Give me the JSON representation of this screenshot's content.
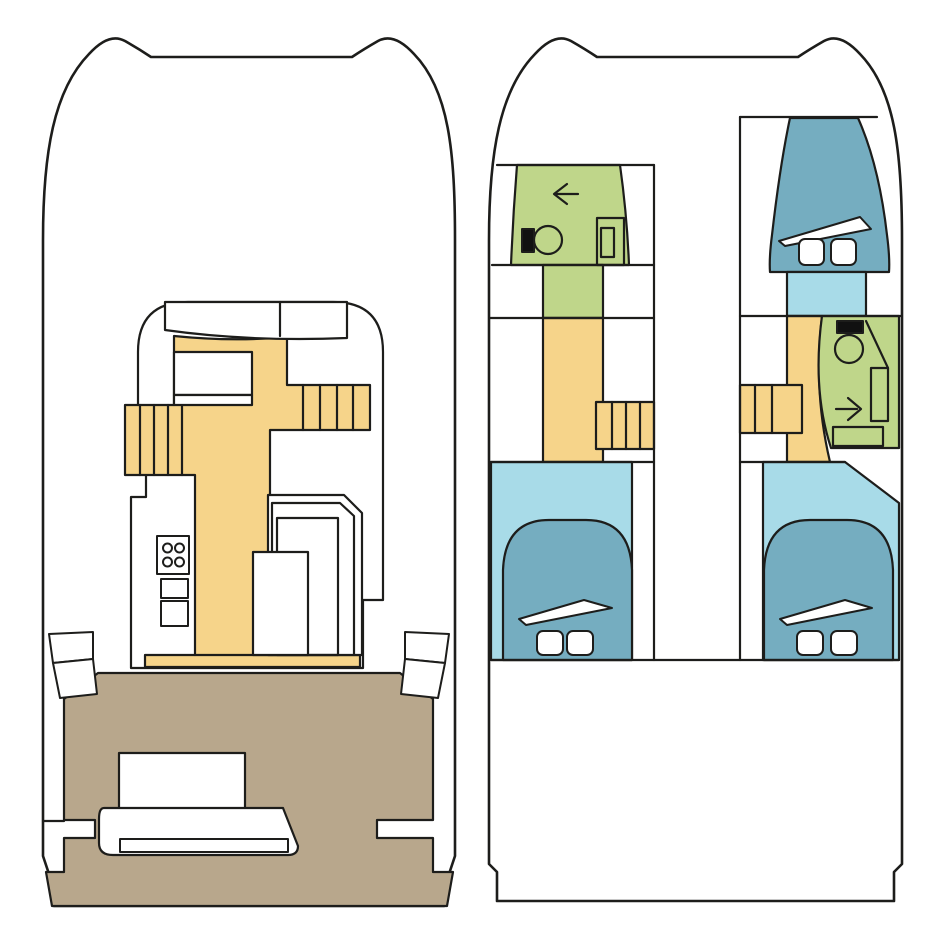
{
  "page": {
    "title": "Catamaran deck plans",
    "description": "Top-view floor plan of a sailing catamaran shown as two drawings: main deck (saloon, galley, cockpit) on the left and lower deck (hull cabins, heads, stairs) on the right."
  },
  "colors": {
    "background": "#ffffff",
    "outline": "#1d1d1b",
    "white": "#ffffff",
    "walkway_yellow": "#f6d48a",
    "cockpit_brown": "#b8a78c",
    "bathroom_green": "#bfd68a",
    "cabin_blue": "#a8dbe8",
    "bed_blue": "#75adc0",
    "fixture_black": "#111111"
  },
  "plans": [
    {
      "id": "main-deck",
      "label": "Main deck - saloon, galley and cockpit",
      "rooms": [
        {
          "name": "foredeck",
          "surface": "white"
        },
        {
          "name": "saloon",
          "surface": "white",
          "features": [
            "front-seat-panels",
            "saloon-table",
            "bench-strip"
          ]
        },
        {
          "name": "walkway",
          "surface": "walkway_yellow"
        },
        {
          "name": "port-stairs",
          "surface": "walkway_yellow",
          "steps": 5
        },
        {
          "name": "starboard-stairs",
          "surface": "walkway_yellow",
          "steps": 5
        },
        {
          "name": "galley",
          "features": [
            "stove-four-burners",
            "double-sink"
          ]
        },
        {
          "name": "dinette",
          "features": [
            "l-shaped-settee",
            "table"
          ]
        },
        {
          "name": "cockpit",
          "surface": "cockpit_brown",
          "features": [
            "cockpit-table",
            "bench-seat",
            "port-side-steps",
            "starboard-side-steps"
          ]
        }
      ]
    },
    {
      "id": "lower-deck",
      "label": "Lower deck - hull cabins and heads",
      "rooms": [
        {
          "name": "port-forward-head",
          "surface": "bathroom_green",
          "features": [
            "toilet",
            "vanity-sink",
            "door-arrow-left"
          ]
        },
        {
          "name": "port-corridor",
          "surface": "walkway_yellow"
        },
        {
          "name": "port-stairs",
          "surface": "walkway_yellow",
          "steps": 4
        },
        {
          "name": "port-aft-cabin",
          "surface": "cabin_blue",
          "features": [
            "double-bed",
            "two-pillows",
            "blanket-fold"
          ]
        },
        {
          "name": "starboard-forward-cabin",
          "surface": "cabin_blue",
          "features": [
            "double-bed",
            "two-pillows",
            "blanket-fold"
          ]
        },
        {
          "name": "starboard-head",
          "surface": "bathroom_green",
          "features": [
            "toilet",
            "shower",
            "sink",
            "door-arrow-right"
          ]
        },
        {
          "name": "starboard-corridor",
          "surface": "walkway_yellow"
        },
        {
          "name": "starboard-stairs",
          "surface": "walkway_yellow",
          "steps": 3
        },
        {
          "name": "starboard-aft-cabin",
          "surface": "cabin_blue",
          "features": [
            "double-bed",
            "two-pillows",
            "blanket-fold"
          ]
        },
        {
          "name": "aft-platform",
          "surface": "white"
        }
      ]
    }
  ]
}
